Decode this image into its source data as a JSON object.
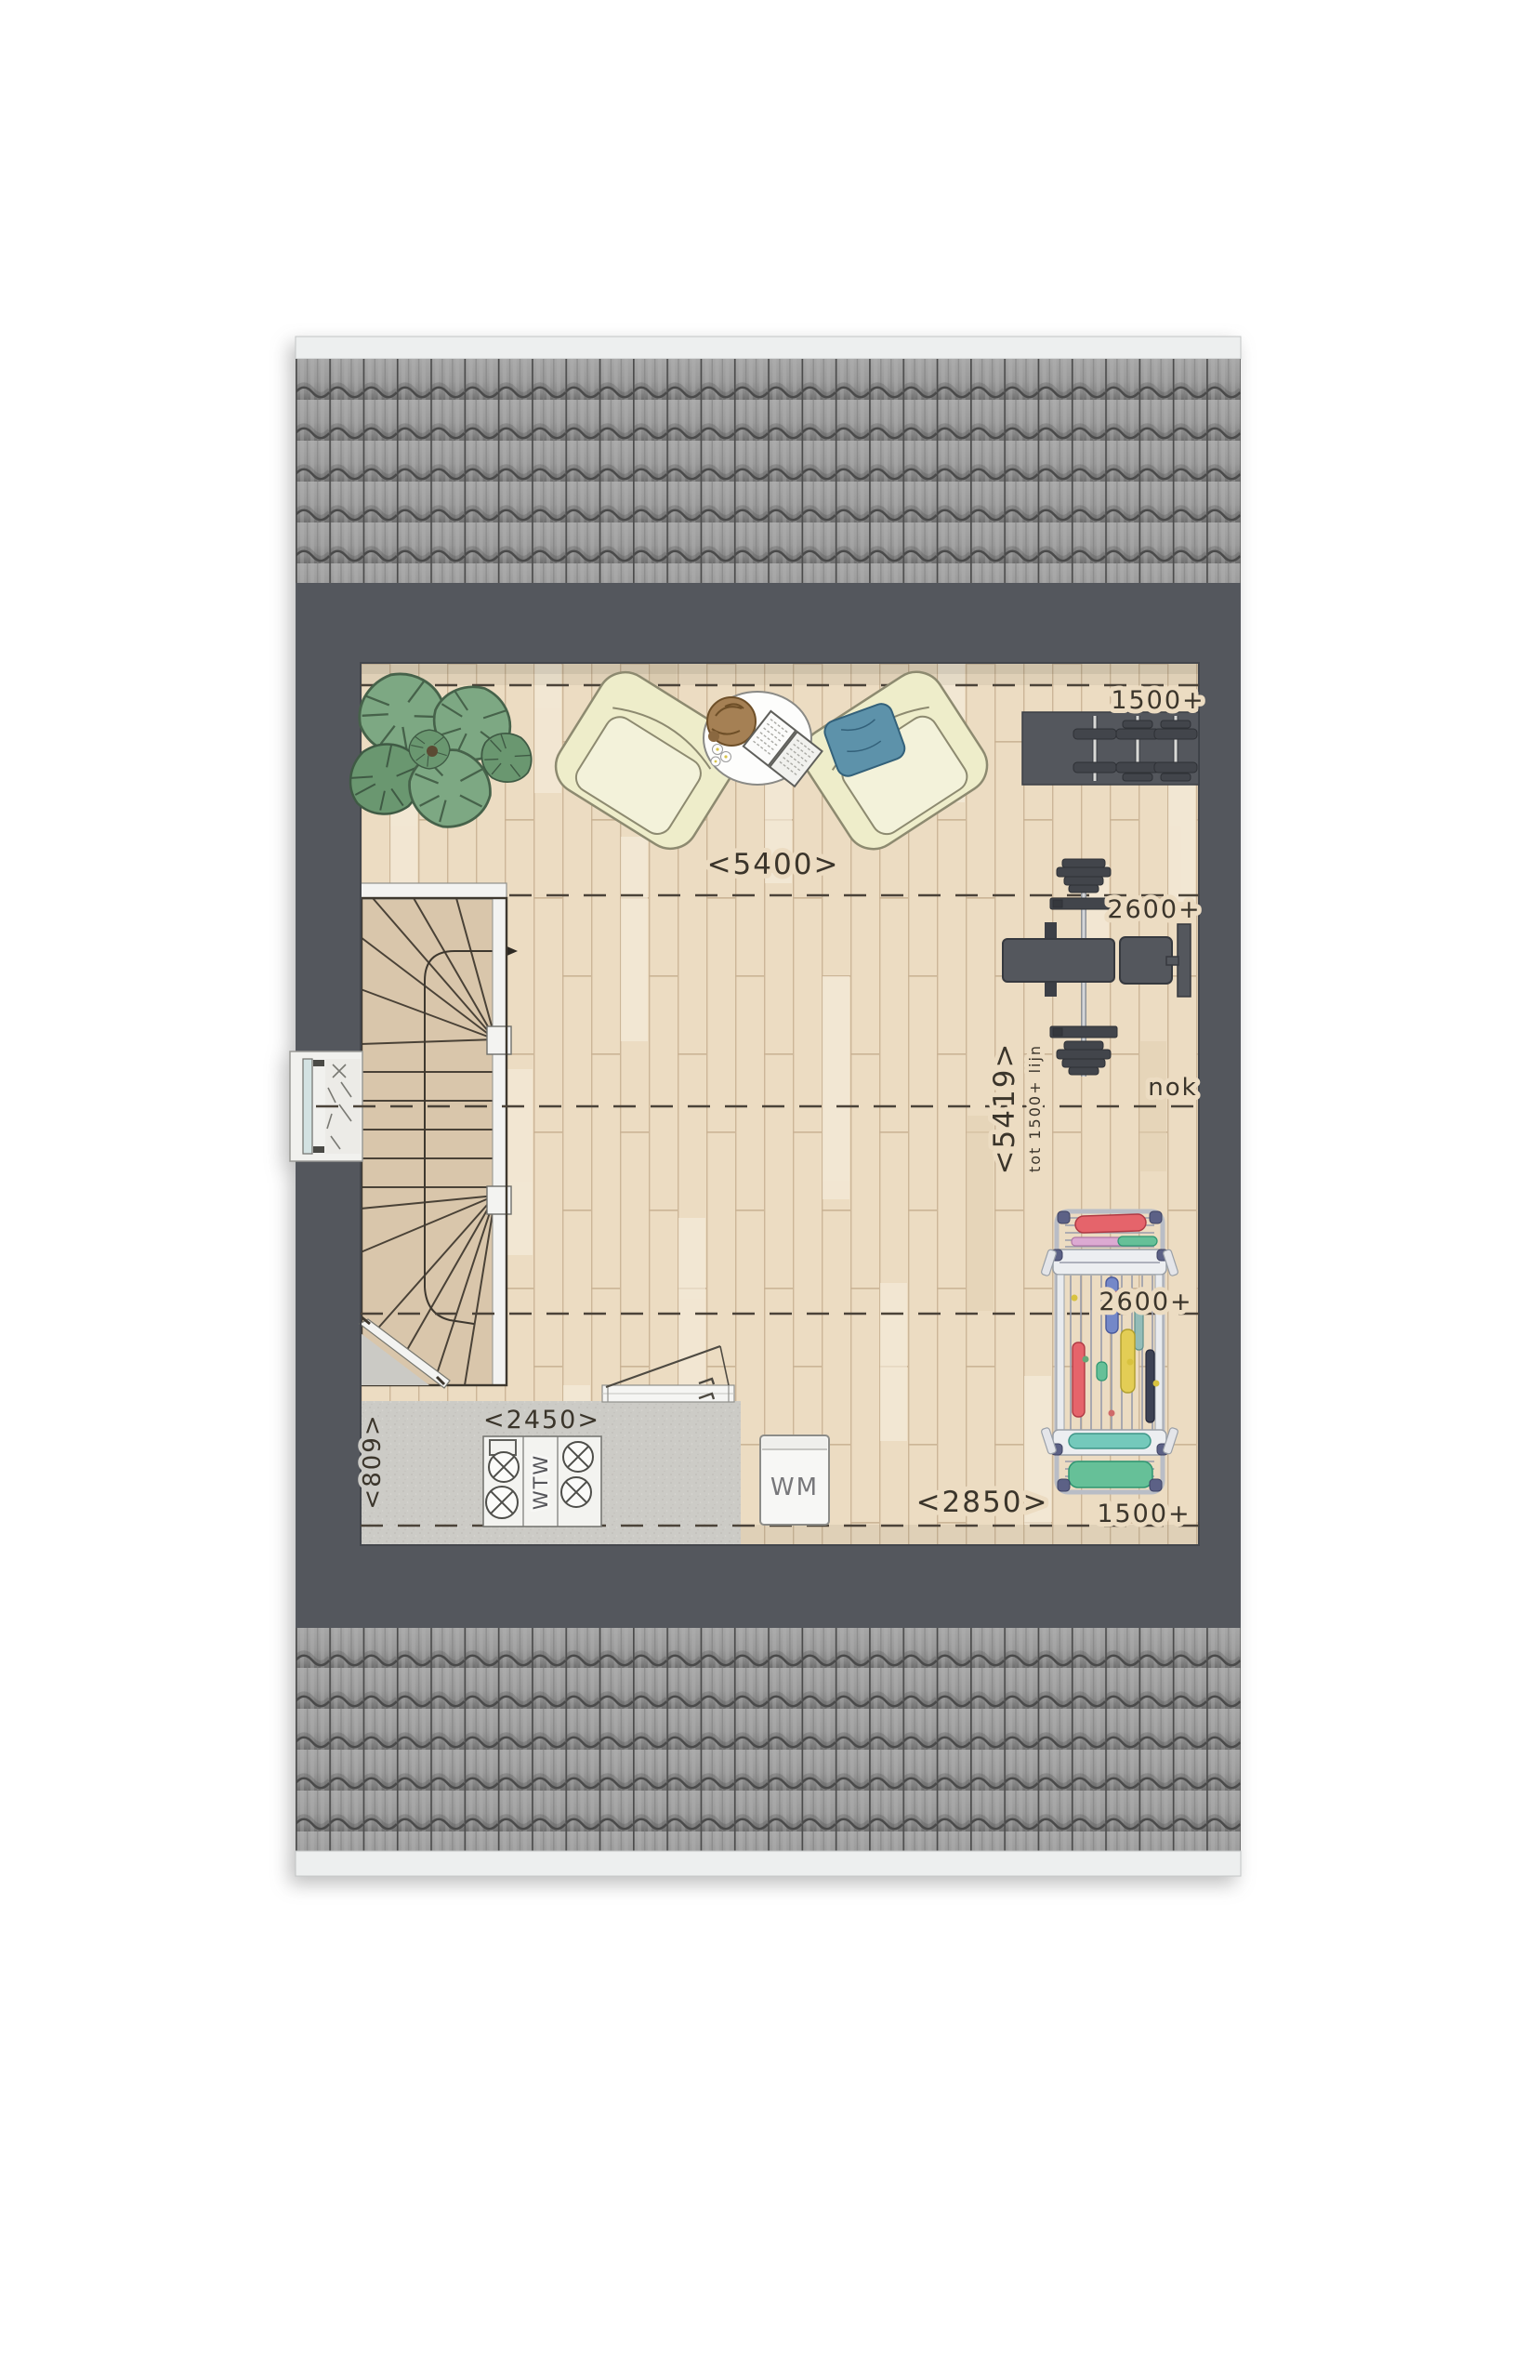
{
  "plan": {
    "labels": {
      "height_1500_top": "1500+",
      "width_5400": "<5400>",
      "height_2600_top": "2600+",
      "void_5419": "<5419>",
      "void_note": "tot 1500+ lijn",
      "ridge_nok": "nok",
      "height_2600_bottom": "2600+",
      "height_1500_bottom": "1500+",
      "width_2850": "<2850>",
      "width_2450": "<2450>",
      "depth_809": "<809>",
      "appliance_wm": "WM",
      "appliance_wtw": "WTW"
    },
    "colors": {
      "wall": "#54575d",
      "roof_tile": "#9a9a9a",
      "roof_edge_strip": "#edefef",
      "floor_wood": "#ecdcc2",
      "floor_joint": "#c9b294",
      "utility_floor": "#cccbc6",
      "stair_wood": "#d9c6ab",
      "label_ink": "#3b352b",
      "chair_cream": "#eeedca",
      "pillow_blue": "#5d92aa",
      "plant_green": "#7da883",
      "plant_green_dark": "#6a9770",
      "gym_dark": "#54575d",
      "laundry_red": "#e5646b",
      "laundry_green": "#66c098",
      "laundry_blue": "#7488c8",
      "laundry_yellow": "#e3cd55",
      "laundry_frame_knob": "#5c6186"
    }
  }
}
